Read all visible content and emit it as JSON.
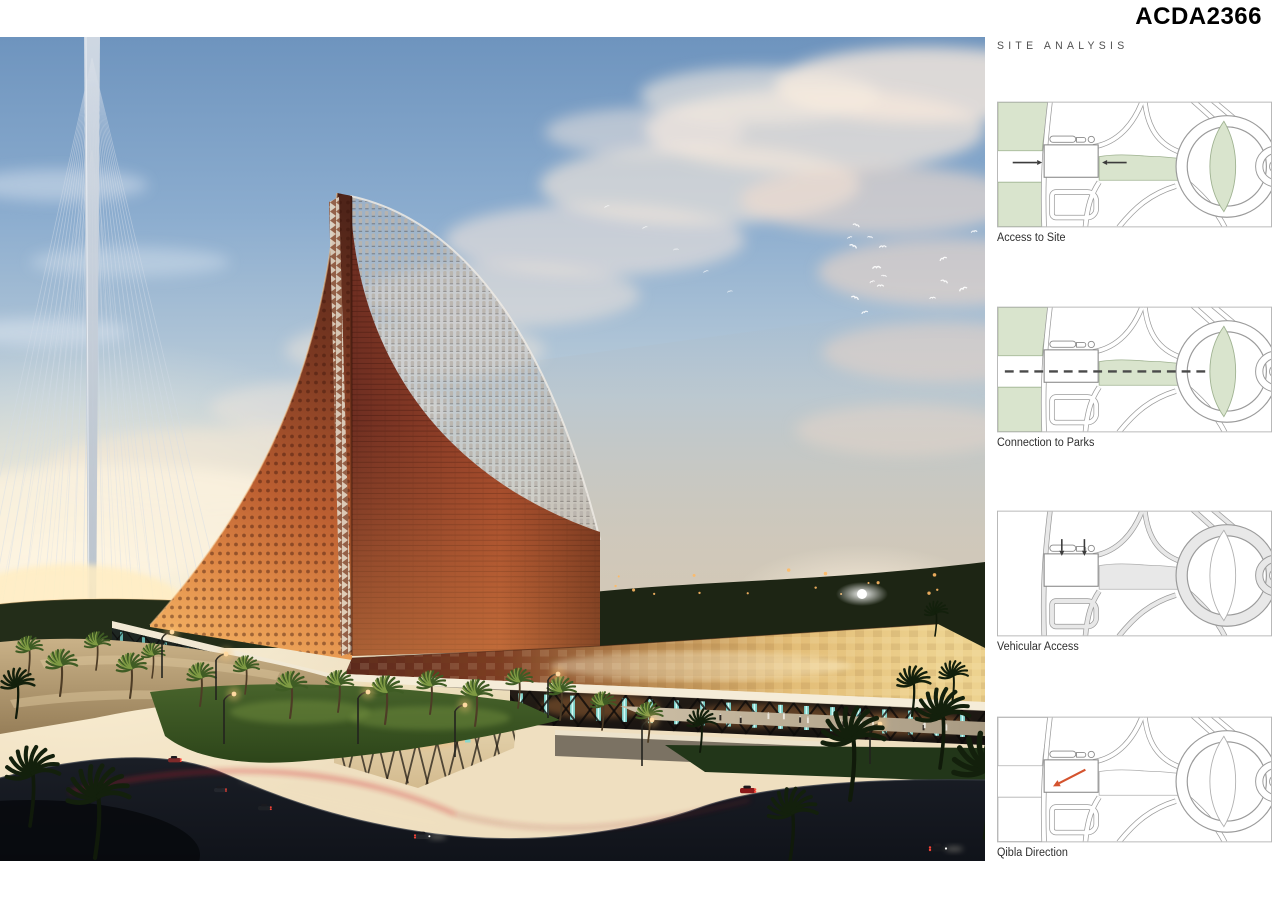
{
  "header": {
    "board_id": "ACDA2366"
  },
  "sidebar": {
    "section_title": "SITE ANALYSIS"
  },
  "palette": {
    "map_green": "#d9e4cd",
    "map_green_stroke": "#9fb291",
    "map_outline": "#9b9b9b",
    "map_road_gray": "#e8e8e8",
    "map_frame": "#b8b8b8",
    "building_fill": "#ffffff",
    "building_stroke": "#8a8a8a",
    "qibla_arrow": "#d4532e",
    "hero_brick": "#9c4429",
    "hero_gold_roof": "#e3bd77",
    "hero_teal_columns": "#7fd9d2",
    "hero_sky_top": "#6e94be"
  },
  "diagrams": [
    {
      "label": "Access to Site",
      "parks": "green",
      "corridor": "green",
      "road_fill": "white",
      "arrow_color": "#3c3c3c",
      "overlays": [
        {
          "type": "arrow",
          "x1": 16,
          "y1": 62,
          "x2": 46,
          "y2": 62
        },
        {
          "type": "arrow",
          "x1": 132,
          "y1": 62,
          "x2": 107,
          "y2": 62
        }
      ]
    },
    {
      "label": "Connection to Parks",
      "parks": "green",
      "corridor": "green",
      "road_fill": "white",
      "arrow_color": "#4a4a4a",
      "overlays": [
        {
          "type": "dashed",
          "x1": 8,
          "y1": 66,
          "x2": 216,
          "y2": 66
        }
      ]
    },
    {
      "label": "Vehicular Access",
      "parks": "none",
      "corridor": "gray",
      "road_fill": "gray",
      "arrow_color": "#3c3c3c",
      "overlays": [
        {
          "type": "arrow",
          "x1": 66,
          "y1": 29,
          "x2": 66,
          "y2": 46
        },
        {
          "type": "arrow",
          "x1": 89,
          "y1": 29,
          "x2": 89,
          "y2": 46
        }
      ]
    },
    {
      "label": "Qibla Direction",
      "parks": "outline",
      "corridor": "outline",
      "road_fill": "white",
      "arrow_color": "#d4532e",
      "overlays": [
        {
          "type": "arrow",
          "x1": 90,
          "y1": 54,
          "x2": 57,
          "y2": 71,
          "w": 2.2
        }
      ]
    }
  ]
}
